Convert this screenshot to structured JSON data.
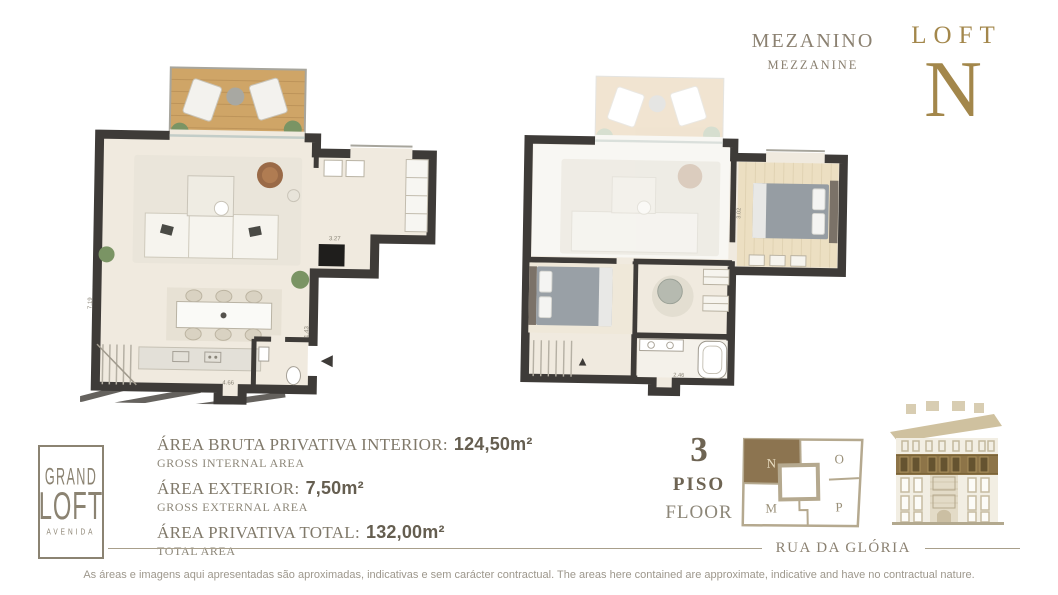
{
  "header": {
    "plan_label_pt": "MEZANINO",
    "plan_label_en": "MEZZANINE",
    "brand_word": "LOFT",
    "unit_letter": "N",
    "accent_color": "#a3874b",
    "text_color": "#8b8171"
  },
  "logo": {
    "line1": "GRAND",
    "line2": "LOFT",
    "line3": "AVENIDA",
    "color": "#8b8372"
  },
  "areas": {
    "rows": [
      {
        "label": "ÁREA BRUTA PRIVATIVA INTERIOR:",
        "value": "124,50m²",
        "sublabel": "GROSS INTERNAL AREA"
      },
      {
        "label": "ÁREA EXTERIOR:",
        "value": "7,50m²",
        "sublabel": "GROSS EXTERNAL AREA"
      },
      {
        "label": "ÁREA PRIVATIVA TOTAL:",
        "value": "132,00m²",
        "sublabel": "TOTAL AREA"
      }
    ]
  },
  "floor_indicator": {
    "number": "3",
    "label_pt": "PISO",
    "label_en": "FLOOR"
  },
  "unit_map": {
    "units": [
      "N",
      "O",
      "M",
      "P"
    ],
    "highlighted_unit": "N",
    "highlight_color": "#8c7450",
    "line_color": "#b5a98f"
  },
  "street": {
    "name": "RUA DA GLÓRIA"
  },
  "plans": {
    "wall_color": "#3e3b38",
    "floor_color": "#f0eadf",
    "terrace_wood_color": "#cfa567",
    "dims": [
      "7.19",
      "3.27",
      "4.66",
      "1.43",
      "3.02",
      "2.46"
    ]
  },
  "building": {
    "highlight_color": "#8d7448",
    "facade_color": "#f2eee3"
  },
  "page": {
    "disclaimer": "As áreas e imagens aqui apresentadas são aproximadas, indicativas e sem carácter contractual. The areas here contained are approximate, indicative and have no contractual nature."
  }
}
